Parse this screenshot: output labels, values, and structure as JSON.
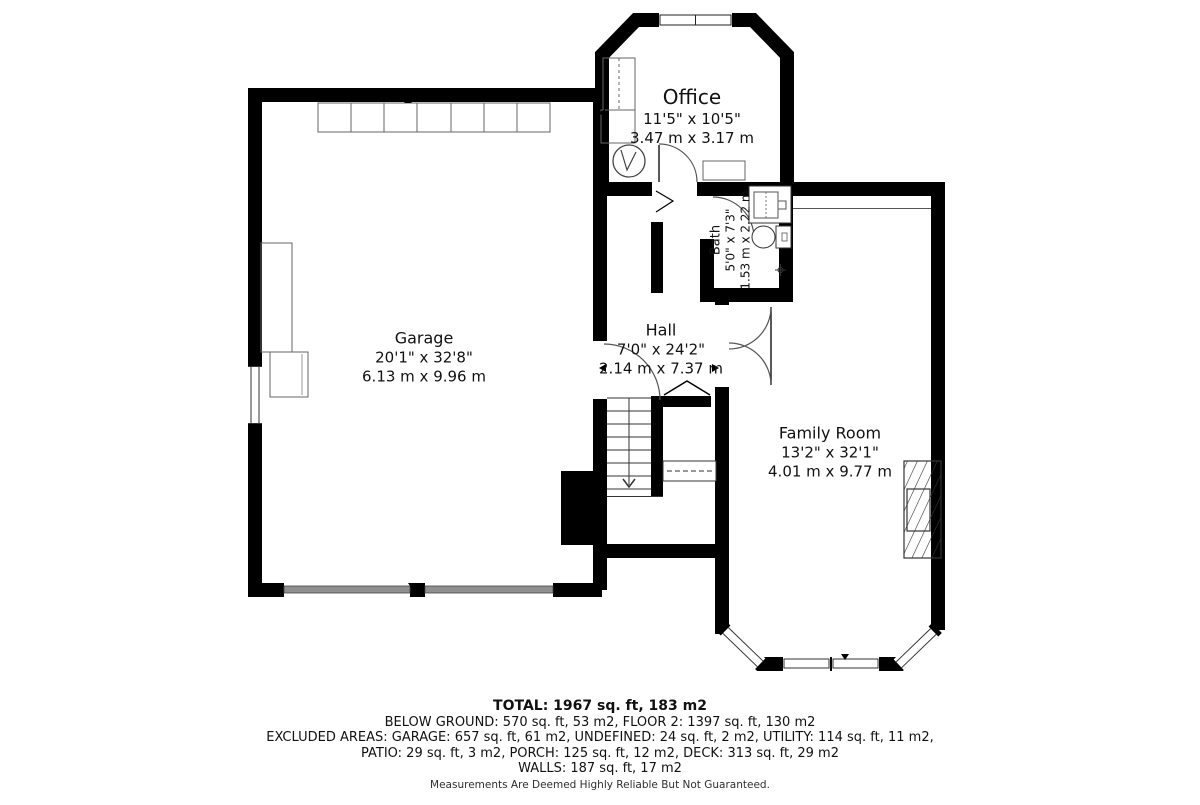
{
  "rooms": {
    "office": {
      "name": "Office",
      "dims_ft": "11'5\" x 10'5\"",
      "dims_m": "3.47 m x 3.17 m"
    },
    "bath": {
      "name": "Bath",
      "dims_ft": "5'0\" x 7'3\"",
      "dims_m": "1.53 m x 2.22 m"
    },
    "garage": {
      "name": "Garage",
      "dims_ft": "20'1\" x 32'8\"",
      "dims_m": "6.13 m x 9.96 m"
    },
    "hall": {
      "name": "Hall",
      "dims_ft": "7'0\" x 24'2\"",
      "dims_m": "2.14 m x 7.37 m"
    },
    "family_room": {
      "name": "Family Room",
      "dims_ft": "13'2\" x 32'1\"",
      "dims_m": "4.01 m x 9.77 m"
    }
  },
  "summary": {
    "total": "TOTAL: 1967 sq. ft, 183 m2",
    "line2": "BELOW GROUND: 570 sq. ft, 53 m2, FLOOR 2: 1397 sq. ft, 130 m2",
    "line3": "EXCLUDED AREAS: GARAGE: 657 sq. ft, 61 m2, UNDEFINED: 24 sq. ft, 2 m2, UTILITY: 114 sq. ft, 11 m2,",
    "line4": "PATIO: 29 sq. ft, 3 m2, PORCH: 125 sq. ft, 12 m2, DECK: 313 sq. ft, 29 m2",
    "line5": "WALLS: 187 sq. ft, 17 m2"
  },
  "disclaimer": "Measurements Are Deemed Highly Reliable But Not Guaranteed.",
  "icons": {
    "stairs_down_arrow": "v-chevron-down",
    "measurement_tick": "small-solid-triangle",
    "fireplace": "diagonal-hatched-rectangle",
    "door_swing": "quarter-circle-arc"
  },
  "colors": {
    "wall": "#000000",
    "fixture_outline": "#666666",
    "garage_door": "#8f8f8f",
    "text": "#111111",
    "disclaimer_text": "#2e2e2e",
    "background": "#ffffff"
  }
}
